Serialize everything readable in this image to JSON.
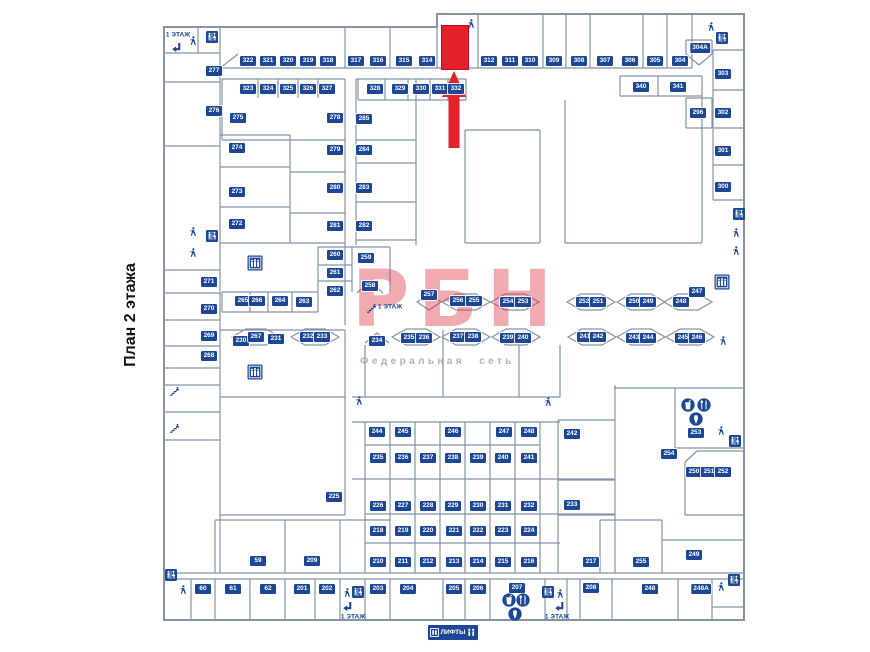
{
  "page": {
    "title": "План 2 этажа"
  },
  "watermark": {
    "logo": "РБН",
    "subtitle": "Федеральная сеть"
  },
  "colors": {
    "label_bg": "#1c4796",
    "wall": "#8592a9",
    "highlight_red": "#e3212b"
  },
  "lifts": {
    "label": "ЛИФТЫ"
  },
  "plan": {
    "highlight": {
      "x": 441,
      "y": 25,
      "w": 26,
      "h": 43
    },
    "floor_signs": [
      {
        "label": "1 ЭТАЖ",
        "x": 178,
        "y": 35,
        "wrap": false
      },
      {
        "label": "1 ЭТАЖ",
        "x": 390,
        "y": 307,
        "wrap": true
      },
      {
        "label": "1 ЭТАЖ",
        "x": 353,
        "y": 617,
        "wrap": false
      },
      {
        "label": "1 ЭТАЖ",
        "x": 557,
        "y": 617,
        "wrap": false
      }
    ],
    "units": [
      {
        "n": "322",
        "x": 248,
        "y": 61
      },
      {
        "n": "321",
        "x": 268,
        "y": 61
      },
      {
        "n": "320",
        "x": 288,
        "y": 61
      },
      {
        "n": "319",
        "x": 308,
        "y": 61
      },
      {
        "n": "318",
        "x": 328,
        "y": 61
      },
      {
        "n": "317",
        "x": 356,
        "y": 61
      },
      {
        "n": "316",
        "x": 378,
        "y": 61
      },
      {
        "n": "315",
        "x": 404,
        "y": 61
      },
      {
        "n": "314",
        "x": 427,
        "y": 61
      },
      {
        "n": "312",
        "x": 489,
        "y": 61
      },
      {
        "n": "311",
        "x": 510,
        "y": 61
      },
      {
        "n": "310",
        "x": 530,
        "y": 61
      },
      {
        "n": "309",
        "x": 554,
        "y": 61
      },
      {
        "n": "308",
        "x": 579,
        "y": 61
      },
      {
        "n": "307",
        "x": 605,
        "y": 61
      },
      {
        "n": "306",
        "x": 630,
        "y": 61
      },
      {
        "n": "305",
        "x": 655,
        "y": 61
      },
      {
        "n": "304",
        "x": 680,
        "y": 61
      },
      {
        "n": "304А",
        "x": 700,
        "y": 48
      },
      {
        "n": "323",
        "x": 248,
        "y": 89
      },
      {
        "n": "324",
        "x": 268,
        "y": 89
      },
      {
        "n": "325",
        "x": 288,
        "y": 89
      },
      {
        "n": "326",
        "x": 308,
        "y": 89
      },
      {
        "n": "327",
        "x": 327,
        "y": 89
      },
      {
        "n": "328",
        "x": 375,
        "y": 89
      },
      {
        "n": "329",
        "x": 400,
        "y": 89
      },
      {
        "n": "330",
        "x": 421,
        "y": 89
      },
      {
        "n": "331",
        "x": 440,
        "y": 89
      },
      {
        "n": "332",
        "x": 456,
        "y": 89
      },
      {
        "n": "340",
        "x": 641,
        "y": 87
      },
      {
        "n": "341",
        "x": 678,
        "y": 87
      },
      {
        "n": "277",
        "x": 214,
        "y": 71
      },
      {
        "n": "276",
        "x": 214,
        "y": 111
      },
      {
        "n": "275",
        "x": 238,
        "y": 118
      },
      {
        "n": "278",
        "x": 335,
        "y": 118
      },
      {
        "n": "285",
        "x": 364,
        "y": 119
      },
      {
        "n": "303",
        "x": 723,
        "y": 74
      },
      {
        "n": "296",
        "x": 698,
        "y": 113
      },
      {
        "n": "302",
        "x": 723,
        "y": 113
      },
      {
        "n": "301",
        "x": 723,
        "y": 151
      },
      {
        "n": "300",
        "x": 723,
        "y": 187
      },
      {
        "n": "274",
        "x": 237,
        "y": 148
      },
      {
        "n": "279",
        "x": 335,
        "y": 150
      },
      {
        "n": "284",
        "x": 364,
        "y": 150
      },
      {
        "n": "273",
        "x": 237,
        "y": 192
      },
      {
        "n": "280",
        "x": 335,
        "y": 188
      },
      {
        "n": "283",
        "x": 364,
        "y": 188
      },
      {
        "n": "272",
        "x": 237,
        "y": 224
      },
      {
        "n": "281",
        "x": 335,
        "y": 226
      },
      {
        "n": "282",
        "x": 364,
        "y": 226
      },
      {
        "n": "260",
        "x": 335,
        "y": 255
      },
      {
        "n": "259",
        "x": 366,
        "y": 258
      },
      {
        "n": "261",
        "x": 335,
        "y": 273
      },
      {
        "n": "258",
        "x": 370,
        "y": 286
      },
      {
        "n": "262",
        "x": 335,
        "y": 291
      },
      {
        "n": "271",
        "x": 209,
        "y": 282
      },
      {
        "n": "270",
        "x": 209,
        "y": 309
      },
      {
        "n": "269",
        "x": 209,
        "y": 336
      },
      {
        "n": "268",
        "x": 209,
        "y": 356
      },
      {
        "n": "265",
        "x": 243,
        "y": 301
      },
      {
        "n": "266",
        "x": 257,
        "y": 301
      },
      {
        "n": "264",
        "x": 280,
        "y": 301
      },
      {
        "n": "263",
        "x": 304,
        "y": 302
      },
      {
        "n": "257",
        "x": 429,
        "y": 295
      },
      {
        "n": "256",
        "x": 458,
        "y": 301
      },
      {
        "n": "255",
        "x": 474,
        "y": 301
      },
      {
        "n": "254",
        "x": 508,
        "y": 302
      },
      {
        "n": "253",
        "x": 523,
        "y": 302
      },
      {
        "n": "252",
        "x": 584,
        "y": 302
      },
      {
        "n": "251",
        "x": 598,
        "y": 302
      },
      {
        "n": "250",
        "x": 634,
        "y": 302
      },
      {
        "n": "249",
        "x": 648,
        "y": 302
      },
      {
        "n": "248",
        "x": 681,
        "y": 302
      },
      {
        "n": "247",
        "x": 697,
        "y": 292
      },
      {
        "n": "230",
        "x": 241,
        "y": 341
      },
      {
        "n": "267",
        "x": 256,
        "y": 337
      },
      {
        "n": "231",
        "x": 276,
        "y": 339
      },
      {
        "n": "232",
        "x": 308,
        "y": 337
      },
      {
        "n": "233",
        "x": 322,
        "y": 337
      },
      {
        "n": "234",
        "x": 377,
        "y": 341
      },
      {
        "n": "235",
        "x": 409,
        "y": 338
      },
      {
        "n": "236",
        "x": 424,
        "y": 338
      },
      {
        "n": "237",
        "x": 458,
        "y": 337
      },
      {
        "n": "238",
        "x": 473,
        "y": 337
      },
      {
        "n": "239",
        "x": 508,
        "y": 338
      },
      {
        "n": "240",
        "x": 523,
        "y": 338
      },
      {
        "n": "241",
        "x": 585,
        "y": 337
      },
      {
        "n": "242",
        "x": 598,
        "y": 337
      },
      {
        "n": "243",
        "x": 634,
        "y": 338
      },
      {
        "n": "244",
        "x": 648,
        "y": 338
      },
      {
        "n": "245",
        "x": 683,
        "y": 338
      },
      {
        "n": "246",
        "x": 697,
        "y": 338
      },
      {
        "n": "225",
        "x": 334,
        "y": 497
      },
      {
        "n": "242",
        "x": 572,
        "y": 434
      },
      {
        "n": "253",
        "x": 696,
        "y": 433
      },
      {
        "n": "254",
        "x": 669,
        "y": 454
      },
      {
        "n": "250",
        "x": 694,
        "y": 472
      },
      {
        "n": "251",
        "x": 709,
        "y": 472
      },
      {
        "n": "252",
        "x": 723,
        "y": 472
      },
      {
        "n": "233",
        "x": 572,
        "y": 505
      },
      {
        "n": "244",
        "x": 377,
        "y": 432
      },
      {
        "n": "245",
        "x": 403,
        "y": 432
      },
      {
        "n": "246",
        "x": 453,
        "y": 432
      },
      {
        "n": "247",
        "x": 504,
        "y": 432
      },
      {
        "n": "248",
        "x": 529,
        "y": 432
      },
      {
        "n": "235",
        "x": 378,
        "y": 458
      },
      {
        "n": "236",
        "x": 403,
        "y": 458
      },
      {
        "n": "237",
        "x": 428,
        "y": 458
      },
      {
        "n": "238",
        "x": 453,
        "y": 458
      },
      {
        "n": "239",
        "x": 478,
        "y": 458
      },
      {
        "n": "240",
        "x": 503,
        "y": 458
      },
      {
        "n": "241",
        "x": 529,
        "y": 458
      },
      {
        "n": "226",
        "x": 378,
        "y": 506
      },
      {
        "n": "227",
        "x": 403,
        "y": 506
      },
      {
        "n": "228",
        "x": 428,
        "y": 506
      },
      {
        "n": "229",
        "x": 453,
        "y": 506
      },
      {
        "n": "230",
        "x": 478,
        "y": 506
      },
      {
        "n": "231",
        "x": 503,
        "y": 506
      },
      {
        "n": "232",
        "x": 529,
        "y": 506
      },
      {
        "n": "218",
        "x": 378,
        "y": 531
      },
      {
        "n": "219",
        "x": 403,
        "y": 531
      },
      {
        "n": "220",
        "x": 428,
        "y": 531
      },
      {
        "n": "221",
        "x": 454,
        "y": 531
      },
      {
        "n": "222",
        "x": 478,
        "y": 531
      },
      {
        "n": "223",
        "x": 503,
        "y": 531
      },
      {
        "n": "224",
        "x": 529,
        "y": 531
      },
      {
        "n": "210",
        "x": 378,
        "y": 562
      },
      {
        "n": "211",
        "x": 403,
        "y": 562
      },
      {
        "n": "212",
        "x": 428,
        "y": 562
      },
      {
        "n": "213",
        "x": 454,
        "y": 562
      },
      {
        "n": "214",
        "x": 478,
        "y": 562
      },
      {
        "n": "215",
        "x": 503,
        "y": 562
      },
      {
        "n": "216",
        "x": 529,
        "y": 562
      },
      {
        "n": "217",
        "x": 591,
        "y": 562
      },
      {
        "n": "59",
        "x": 258,
        "y": 561
      },
      {
        "n": "209",
        "x": 312,
        "y": 561
      },
      {
        "n": "255",
        "x": 641,
        "y": 562
      },
      {
        "n": "249",
        "x": 694,
        "y": 555
      },
      {
        "n": "60",
        "x": 203,
        "y": 589
      },
      {
        "n": "61",
        "x": 233,
        "y": 589
      },
      {
        "n": "62",
        "x": 268,
        "y": 589
      },
      {
        "n": "201",
        "x": 302,
        "y": 589
      },
      {
        "n": "202",
        "x": 327,
        "y": 589
      },
      {
        "n": "203",
        "x": 378,
        "y": 589
      },
      {
        "n": "204",
        "x": 408,
        "y": 589
      },
      {
        "n": "205",
        "x": 454,
        "y": 589
      },
      {
        "n": "206",
        "x": 478,
        "y": 589
      },
      {
        "n": "207",
        "x": 517,
        "y": 588
      },
      {
        "n": "208",
        "x": 591,
        "y": 588
      },
      {
        "n": "248",
        "x": 650,
        "y": 589
      },
      {
        "n": "248А",
        "x": 701,
        "y": 589
      }
    ],
    "icons": [
      {
        "t": "person",
        "x": 193,
        "y": 41
      },
      {
        "t": "wc",
        "x": 212,
        "y": 37
      },
      {
        "t": "escarrow",
        "x": 177,
        "y": 48
      },
      {
        "t": "person",
        "x": 471,
        "y": 24
      },
      {
        "t": "person",
        "x": 711,
        "y": 27
      },
      {
        "t": "wc",
        "x": 722,
        "y": 38
      },
      {
        "t": "wc",
        "x": 739,
        "y": 214
      },
      {
        "t": "person",
        "x": 736,
        "y": 233
      },
      {
        "t": "person",
        "x": 736,
        "y": 251
      },
      {
        "t": "person",
        "x": 193,
        "y": 232
      },
      {
        "t": "wc",
        "x": 212,
        "y": 236
      },
      {
        "t": "person",
        "x": 193,
        "y": 253
      },
      {
        "t": "elev",
        "x": 255,
        "y": 263
      },
      {
        "t": "elev",
        "x": 255,
        "y": 372
      },
      {
        "t": "elev",
        "x": 722,
        "y": 282
      },
      {
        "t": "person",
        "x": 723,
        "y": 341
      },
      {
        "t": "escsteps",
        "x": 372,
        "y": 309
      },
      {
        "t": "escsteps",
        "x": 175,
        "y": 392
      },
      {
        "t": "escsteps",
        "x": 175,
        "y": 429
      },
      {
        "t": "person",
        "x": 359,
        "y": 401
      },
      {
        "t": "person",
        "x": 548,
        "y": 402
      },
      {
        "t": "drink",
        "x": 688,
        "y": 405
      },
      {
        "t": "meal",
        "x": 704,
        "y": 405
      },
      {
        "t": "dessert",
        "x": 696,
        "y": 419
      },
      {
        "t": "person",
        "x": 721,
        "y": 431
      },
      {
        "t": "wc",
        "x": 735,
        "y": 441
      },
      {
        "t": "wc",
        "x": 171,
        "y": 575
      },
      {
        "t": "person",
        "x": 183,
        "y": 590
      },
      {
        "t": "person",
        "x": 347,
        "y": 593
      },
      {
        "t": "wc",
        "x": 358,
        "y": 592
      },
      {
        "t": "escarrow",
        "x": 348,
        "y": 607
      },
      {
        "t": "wc",
        "x": 548,
        "y": 592
      },
      {
        "t": "person",
        "x": 560,
        "y": 594
      },
      {
        "t": "escarrow",
        "x": 560,
        "y": 607
      },
      {
        "t": "drink",
        "x": 509,
        "y": 600
      },
      {
        "t": "meal",
        "x": 523,
        "y": 600
      },
      {
        "t": "dessert",
        "x": 515,
        "y": 614
      },
      {
        "t": "wc",
        "x": 734,
        "y": 580
      },
      {
        "t": "person",
        "x": 721,
        "y": 587
      }
    ]
  }
}
